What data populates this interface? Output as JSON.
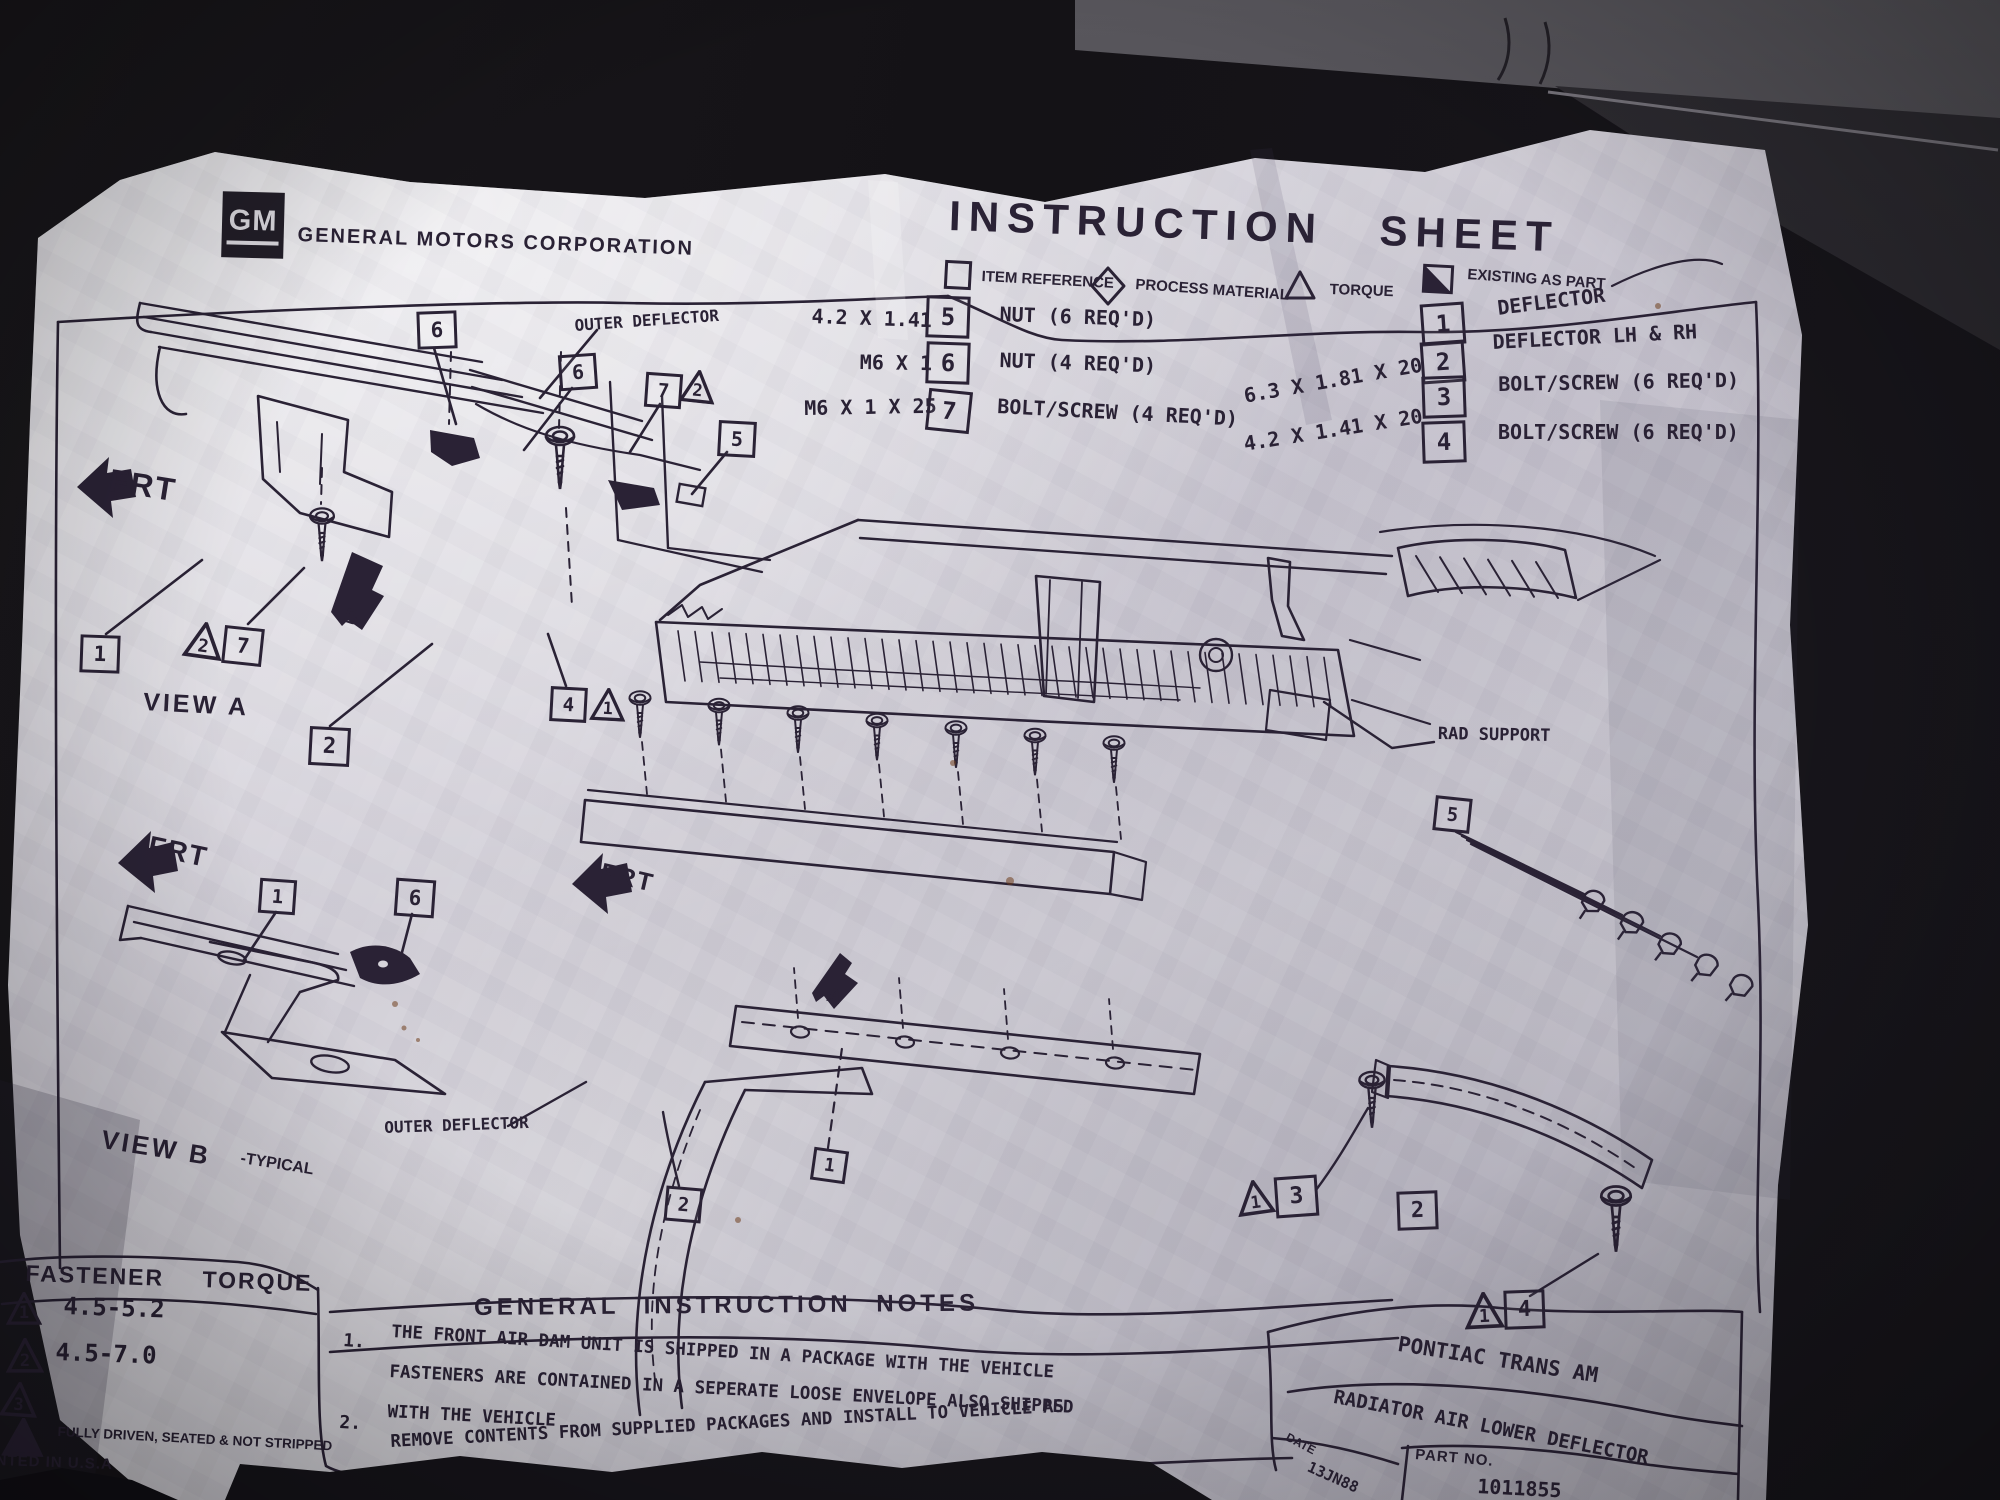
{
  "colors": {
    "paper": "#d6d4da",
    "ink": "#2a2235",
    "background": "#141216",
    "object_gray": "#47454b"
  },
  "sheet": {
    "header": {
      "logo": "GM",
      "company": "GENERAL MOTORS CORPORATION",
      "title": "INSTRUCTION SHEET"
    },
    "legend": [
      {
        "symbol": "square-outline",
        "label": "ITEM REFERENCE"
      },
      {
        "symbol": "diamond-outline",
        "label": "PROCESS MATERIAL"
      },
      {
        "symbol": "triangle-outline",
        "label": "TORQUE"
      },
      {
        "symbol": "half-filled-square",
        "label": "EXISTING AS PART"
      }
    ],
    "parts_left": [
      {
        "size": "4.2 X 1.41",
        "ref": "5",
        "desc": "NUT (6 REQ'D)"
      },
      {
        "size": "M6 X 1",
        "ref": "6",
        "desc": "NUT (4 REQ'D)"
      },
      {
        "size": "M6 X 1 X 25",
        "ref": "7",
        "desc": "BOLT/SCREW (4 REQ'D)"
      }
    ],
    "parts_right": [
      {
        "size": "",
        "ref": "1",
        "desc": "DEFLECTOR"
      },
      {
        "size": "",
        "ref": "2",
        "desc": "DEFLECTOR LH & RH"
      },
      {
        "size": "6.3 X 1.81 X 20",
        "ref": "3",
        "desc": "BOLT/SCREW (6 REQ'D)"
      },
      {
        "size": "4.2 X 1.41 X 20",
        "ref": "4",
        "desc": "BOLT/SCREW (6 REQ'D)"
      }
    ],
    "view_a": {
      "frt": "FRT",
      "caption": "VIEW A",
      "arrow": "B",
      "outer_deflector_label": "OUTER DEFLECTOR"
    },
    "view_b": {
      "frt": "FRT",
      "caption": "VIEW B",
      "caption_suffix": "-TYPICAL"
    },
    "main_view": {
      "frt": "FRT",
      "arrow": "A",
      "rad_support_label": "RAD SUPPORT",
      "outer_deflector_label": "OUTER DEFLECTOR"
    },
    "fastener_torque": {
      "title": "FASTENER TORQUE",
      "rows": [
        {
          "ref": "1",
          "value": "4.5-5.2"
        },
        {
          "ref": "2",
          "value": "4.5-7.0"
        },
        {
          "ref": "3",
          "value": ""
        }
      ],
      "footnote": "FULLY DRIVEN, SEATED & NOT STRIPPED",
      "printed_in": "NTED IN U.S.A",
      "corner": "02"
    },
    "notes": {
      "title": "GENERAL INSTRUCTION NOTES",
      "items": [
        {
          "num": "1.",
          "lines": [
            "THE FRONT AIR DAM UNIT IS SHIPPED IN A PACKAGE WITH THE VEHICLE",
            "FASTENERS ARE CONTAINED IN A SEPERATE LOOSE ENVELOPE ALSO SHIPPED",
            "WITH THE VEHICLE"
          ]
        },
        {
          "num": "2.",
          "lines": [
            "REMOVE CONTENTS FROM SUPPLIED PACKAGES AND INSTALL TO VEHICLE AS",
            "SHOWN ABOVE."
          ]
        }
      ]
    },
    "title_block": {
      "vehicle": "PONTIAC TRANS AM",
      "part_name": "RADIATOR AIR LOWER DEFLECTOR",
      "date_label": "DATE",
      "date_value": "13JN88",
      "part_no_label": "PART NO.",
      "part_no_value": "1011855"
    },
    "callouts": [
      {
        "id": "p5",
        "label": "5",
        "type": "box"
      },
      {
        "id": "p6",
        "label": "6",
        "type": "box"
      },
      {
        "id": "p7",
        "label": "7",
        "type": "box"
      },
      {
        "id": "p1",
        "label": "1",
        "type": "box"
      },
      {
        "id": "p2",
        "label": "2",
        "type": "box"
      },
      {
        "id": "p3",
        "label": "3",
        "type": "box"
      },
      {
        "id": "p4",
        "label": "4",
        "type": "box"
      },
      {
        "id": "va6a",
        "label": "6",
        "type": "box"
      },
      {
        "id": "va6b",
        "label": "6",
        "type": "box"
      },
      {
        "id": "va7a",
        "label": "7",
        "type": "box"
      },
      {
        "id": "vat2a",
        "label": "2",
        "type": "tri"
      },
      {
        "id": "va5",
        "label": "5",
        "type": "box"
      },
      {
        "id": "va1",
        "label": "1",
        "type": "box"
      },
      {
        "id": "vat2b",
        "label": "2",
        "type": "tri"
      },
      {
        "id": "va7b",
        "label": "7",
        "type": "box"
      },
      {
        "id": "va2",
        "label": "2",
        "type": "box"
      },
      {
        "id": "va4",
        "label": "4",
        "type": "box"
      },
      {
        "id": "vat1",
        "label": "1",
        "type": "tri"
      },
      {
        "id": "vb1",
        "label": "1",
        "type": "box"
      },
      {
        "id": "vb6",
        "label": "6",
        "type": "box"
      },
      {
        "id": "m5",
        "label": "5",
        "type": "box"
      },
      {
        "id": "m1",
        "label": "1",
        "type": "box"
      },
      {
        "id": "m2a",
        "label": "2",
        "type": "box"
      },
      {
        "id": "mt1a",
        "label": "1",
        "type": "tri"
      },
      {
        "id": "m3",
        "label": "3",
        "type": "box"
      },
      {
        "id": "m2b",
        "label": "2",
        "type": "box"
      },
      {
        "id": "mt1b",
        "label": "1",
        "type": "tri"
      },
      {
        "id": "m4",
        "label": "4",
        "type": "box"
      },
      {
        "id": "ft1",
        "label": "1",
        "type": "tri"
      },
      {
        "id": "ft2",
        "label": "2",
        "type": "tri"
      },
      {
        "id": "ft3",
        "label": "3",
        "type": "tri"
      },
      {
        "id": "ftf",
        "label": "",
        "type": "tri-filled"
      }
    ]
  }
}
